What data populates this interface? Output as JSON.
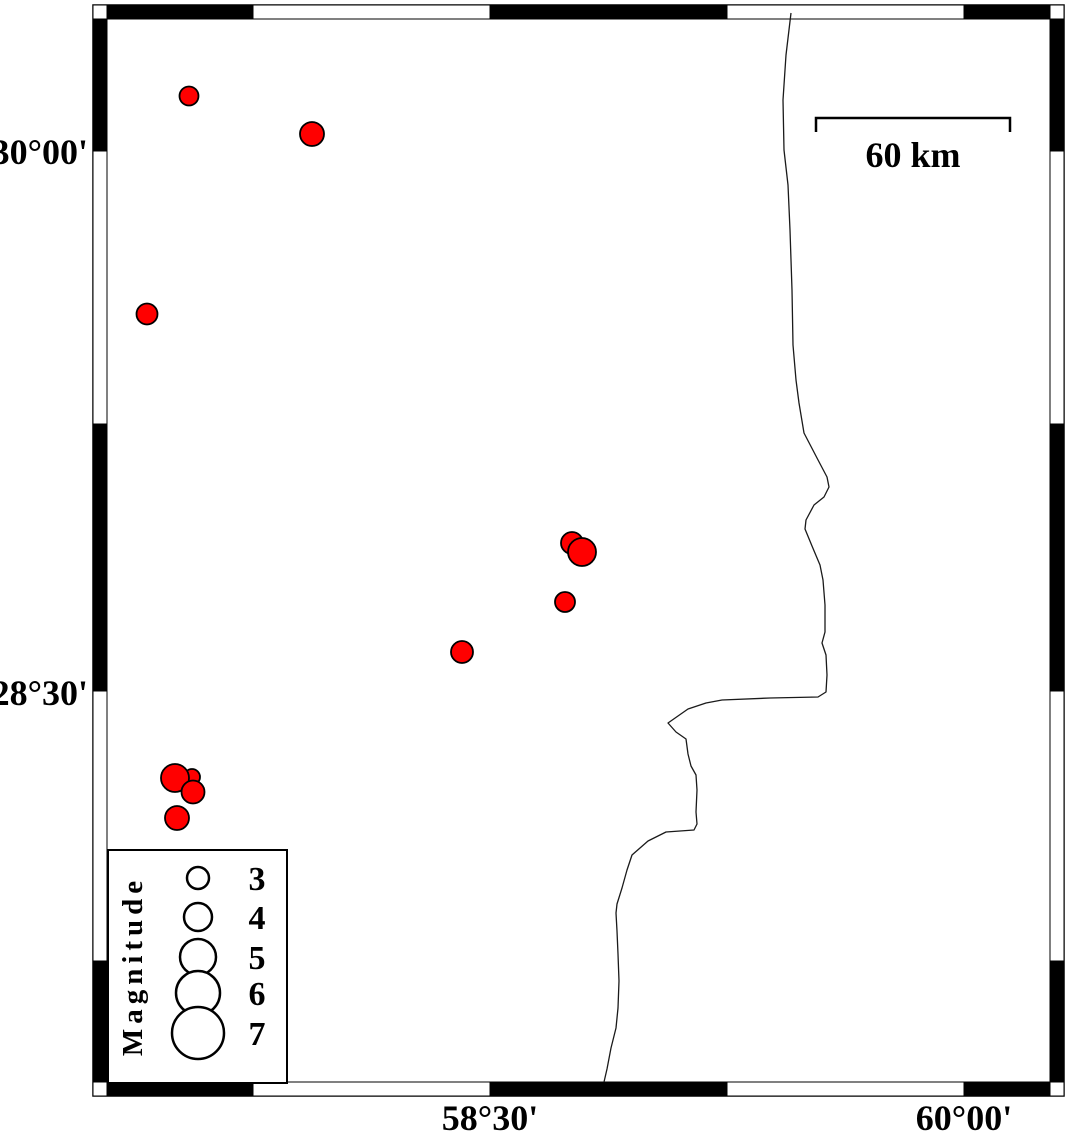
{
  "figure": {
    "width": 1066,
    "height": 1134,
    "background": "#ffffff",
    "description": "Seismicity map with red earthquake epicenter circles scaled by magnitude, coastline, fancy checkered map frame, magnitude legend and 60 km scale bar"
  },
  "map": {
    "frame": {
      "x0": 93,
      "y0": 5,
      "x1": 1064,
      "y1": 1096,
      "t": 14,
      "x_bounds": [
        107,
        253,
        490,
        727,
        964,
        1050
      ],
      "y_bounds": [
        19,
        151,
        424,
        691,
        961,
        1082
      ],
      "dark": "#000000",
      "light": "#ffffff"
    },
    "axis": {
      "lat_x": 88,
      "lon_y": 1130,
      "lat_labels": [
        {
          "text": "30°00'",
          "y": 151
        },
        {
          "text": "28°30'",
          "y": 692
        }
      ],
      "lon_labels": [
        {
          "text": "58°30'",
          "x": 490
        },
        {
          "text": "60°00'",
          "x": 964
        }
      ]
    },
    "scale_bar": {
      "label": "60 km",
      "x1": 816,
      "x2": 1010,
      "y": 118,
      "tick_drop": 14,
      "label_y": 167
    },
    "coastline": {
      "color": "#1a1a1a",
      "points": [
        [
          791,
          13
        ],
        [
          786,
          55
        ],
        [
          783,
          100
        ],
        [
          784,
          150
        ],
        [
          788,
          185
        ],
        [
          790,
          230
        ],
        [
          792,
          290
        ],
        [
          793,
          345
        ],
        [
          796,
          380
        ],
        [
          799,
          403
        ],
        [
          804,
          433
        ],
        [
          817,
          458
        ],
        [
          827,
          477
        ],
        [
          829,
          487
        ],
        [
          824,
          497
        ],
        [
          814,
          505
        ],
        [
          806,
          520
        ],
        [
          805,
          529
        ],
        [
          812,
          546
        ],
        [
          820,
          565
        ],
        [
          823,
          580
        ],
        [
          825,
          605
        ],
        [
          825,
          632
        ],
        [
          822,
          643
        ],
        [
          826,
          655
        ],
        [
          827,
          675
        ],
        [
          826,
          692
        ],
        [
          818,
          697
        ],
        [
          770,
          698
        ],
        [
          722,
          700
        ],
        [
          706,
          703
        ],
        [
          688,
          709
        ],
        [
          668,
          723
        ],
        [
          676,
          732
        ],
        [
          686,
          739
        ],
        [
          688,
          754
        ],
        [
          691,
          766
        ],
        [
          696,
          775
        ],
        [
          697,
          790
        ],
        [
          696,
          812
        ],
        [
          697,
          824
        ],
        [
          694,
          830
        ],
        [
          666,
          832
        ],
        [
          648,
          841
        ],
        [
          632,
          855
        ],
        [
          627,
          870
        ],
        [
          622,
          888
        ],
        [
          617,
          904
        ],
        [
          616,
          913
        ],
        [
          617,
          931
        ],
        [
          618,
          954
        ],
        [
          619,
          981
        ],
        [
          618,
          1008
        ],
        [
          616,
          1028
        ],
        [
          611,
          1048
        ],
        [
          607,
          1069
        ],
        [
          604,
          1082
        ]
      ]
    },
    "earthquakes": {
      "fill": "#ff0000",
      "stroke": "#000000",
      "points": [
        {
          "x": 189,
          "y": 96,
          "r": 9.5,
          "mag_est": 2.6
        },
        {
          "x": 312,
          "y": 134,
          "r": 12,
          "mag_est": 3.3
        },
        {
          "x": 147,
          "y": 314,
          "r": 10.5,
          "mag_est": 2.9
        },
        {
          "x": 572,
          "y": 543,
          "r": 11,
          "mag_est": 3.0
        },
        {
          "x": 582,
          "y": 552,
          "r": 14,
          "mag_est": 4.0
        },
        {
          "x": 565,
          "y": 602,
          "r": 10,
          "mag_est": 2.7
        },
        {
          "x": 462,
          "y": 652,
          "r": 11,
          "mag_est": 3.0
        },
        {
          "x": 192,
          "y": 777,
          "r": 8,
          "mag_est": 2.2
        },
        {
          "x": 175,
          "y": 778,
          "r": 14,
          "mag_est": 4.0
        },
        {
          "x": 193,
          "y": 792,
          "r": 11.5,
          "mag_est": 3.1
        },
        {
          "x": 177,
          "y": 818,
          "r": 12,
          "mag_est": 3.3
        }
      ]
    },
    "legend": {
      "title": "Magnitude",
      "box": [
        108,
        850,
        287,
        1083
      ],
      "title_x": 142,
      "title_y": 966,
      "circle_cx": 198,
      "value_x": 257,
      "entries": [
        {
          "label": "3",
          "cy": 878,
          "r": 11
        },
        {
          "label": "4",
          "cy": 917,
          "r": 14
        },
        {
          "label": "5",
          "cy": 957,
          "r": 18
        },
        {
          "label": "6",
          "cy": 993,
          "r": 22
        },
        {
          "label": "7",
          "cy": 1033,
          "r": 26
        }
      ]
    }
  }
}
